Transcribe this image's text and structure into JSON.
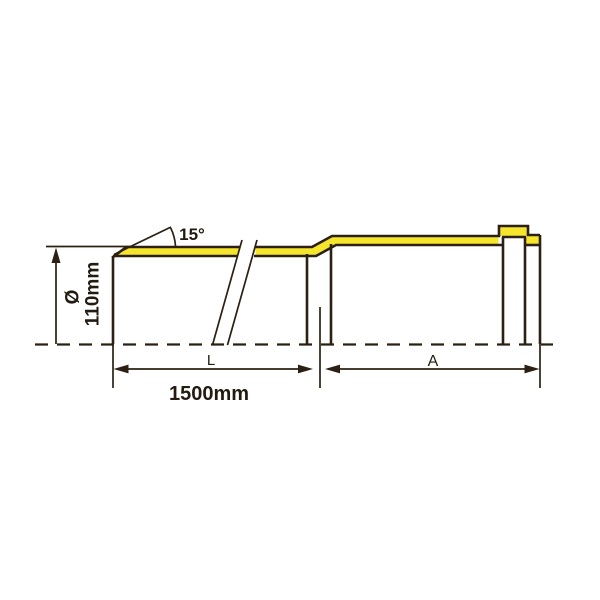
{
  "labels": {
    "chamfer_angle": "15°",
    "diameter_symbol": "Ø",
    "diameter_value": "110mm",
    "length_symbol": "L",
    "length_value": "1500mm",
    "socket_depth_symbol": "A"
  },
  "colors": {
    "highlight": "#F6E52D",
    "line": "#2B2013",
    "text": "#231B0F",
    "background": "#FFFFFF"
  }
}
